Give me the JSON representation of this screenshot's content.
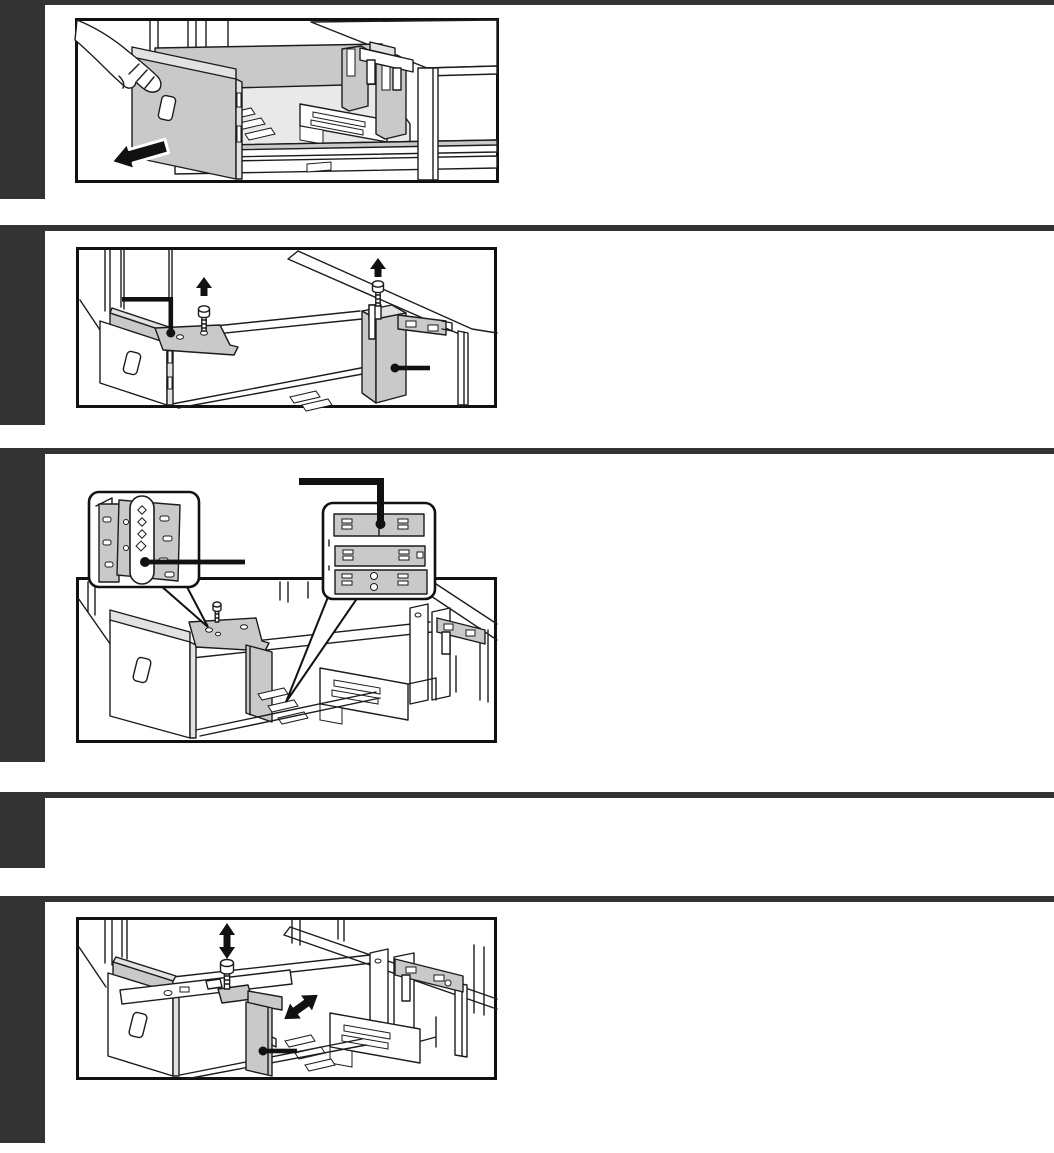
{
  "page": {
    "width": 1054,
    "height": 1153,
    "background_color": "#ffffff"
  },
  "theme": {
    "marker_color": "#333333",
    "rule_color": "#333333",
    "line_color": "#1c1c1c",
    "border_color": "#111111",
    "shade_color": "#c9c9c9",
    "shade_light_color": "#e2e2e2",
    "deck_color": "#e9e9e9",
    "annotation_color": "#111111",
    "figure_bg": "#ffffff"
  },
  "sections": [
    {
      "id": "step-1",
      "figure": {
        "id": "figure-pull-out-tray",
        "icons": [
          "hand-icon",
          "pull-direction-arrow-icon",
          "tabletop",
          "paper-tray",
          "slide-rails"
        ]
      }
    },
    {
      "id": "step-2",
      "figure": {
        "id": "figure-remove-guide-screws",
        "icons": [
          "up-arrow-icon",
          "up-arrow-icon",
          "shoulder-screw-icon",
          "shoulder-screw-icon",
          "elbow-leader-icon",
          "dot-leader-icon"
        ]
      }
    },
    {
      "id": "step-3",
      "figure": {
        "id": "figure-guide-hole-positions",
        "icons": [
          "magnifier-bubble-icon",
          "magnifier-bubble-icon",
          "shoulder-screw-icon",
          "dot-leader-icon",
          "dot-leader-icon",
          "elbow-leader-icon"
        ]
      }
    },
    {
      "id": "step-4",
      "figure": null
    },
    {
      "id": "step-5",
      "figure": {
        "id": "figure-adjust-guide-position",
        "icons": [
          "up-down-arrow-icon",
          "diagonal-double-arrow-icon",
          "shoulder-screw-icon",
          "dot-leader-icon"
        ]
      }
    }
  ]
}
